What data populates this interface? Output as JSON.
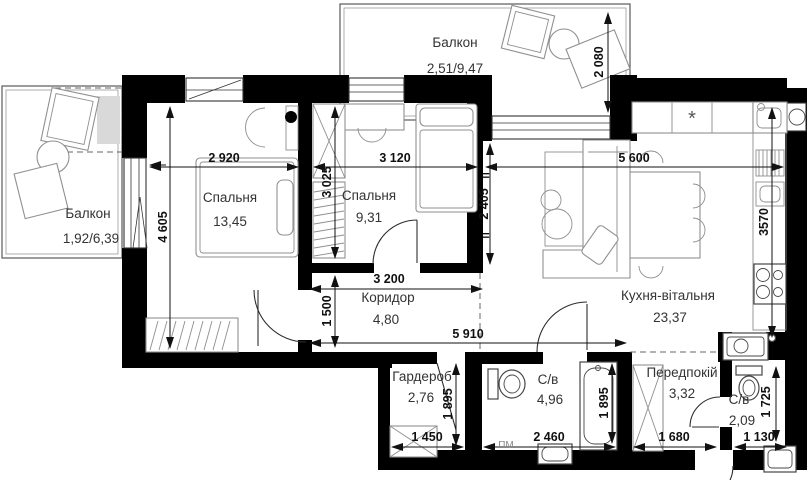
{
  "plan": {
    "rooms": {
      "balcony_top": {
        "name": "Балкон",
        "area": "2,51/9,47"
      },
      "balcony_left": {
        "name": "Балкон",
        "area": "1,92/6,39"
      },
      "bedroom1": {
        "name": "Спальня",
        "area": "13,45"
      },
      "bedroom2": {
        "name": "Спальня",
        "area": "9,31"
      },
      "kitchen_living": {
        "name": "Кухня-вітальня",
        "area": "23,37"
      },
      "corridor": {
        "name": "Коридор",
        "area": "4,80"
      },
      "wardrobe": {
        "name": "Гардероб",
        "area": "2,76"
      },
      "bathroom_main": {
        "name": "С/в",
        "area": "4,96"
      },
      "hallway": {
        "name": "Передпокій",
        "area": "3,32"
      },
      "bathroom_small": {
        "name": "С/в",
        "area": "2,09"
      }
    },
    "dimensions": {
      "balcony_depth": "2 080",
      "bedroom1_width": "2 920",
      "bedroom2_width": "3 120",
      "kitchen_width": "5 600",
      "bedroom1_height": "4 605",
      "bedroom2_height": "3 025",
      "kitchen_left_height": "2 405",
      "kitchen_counter_height": "3570",
      "corridor_width": "3 200",
      "corridor_height": "1 500",
      "corridor_total_width": "5 910",
      "wardrobe_height": "1 895",
      "bathroom_main_height": "1 895",
      "wardrobe_width": "1 450",
      "bathroom_main_width": "2 460",
      "hallway_width": "1 680",
      "bathroom_small_width": "1 130",
      "bathroom_small_height": "1 725"
    },
    "annotations": {
      "washing_machine": "ПМ",
      "hob_symbol": "*",
      "approx_mark": "="
    }
  }
}
